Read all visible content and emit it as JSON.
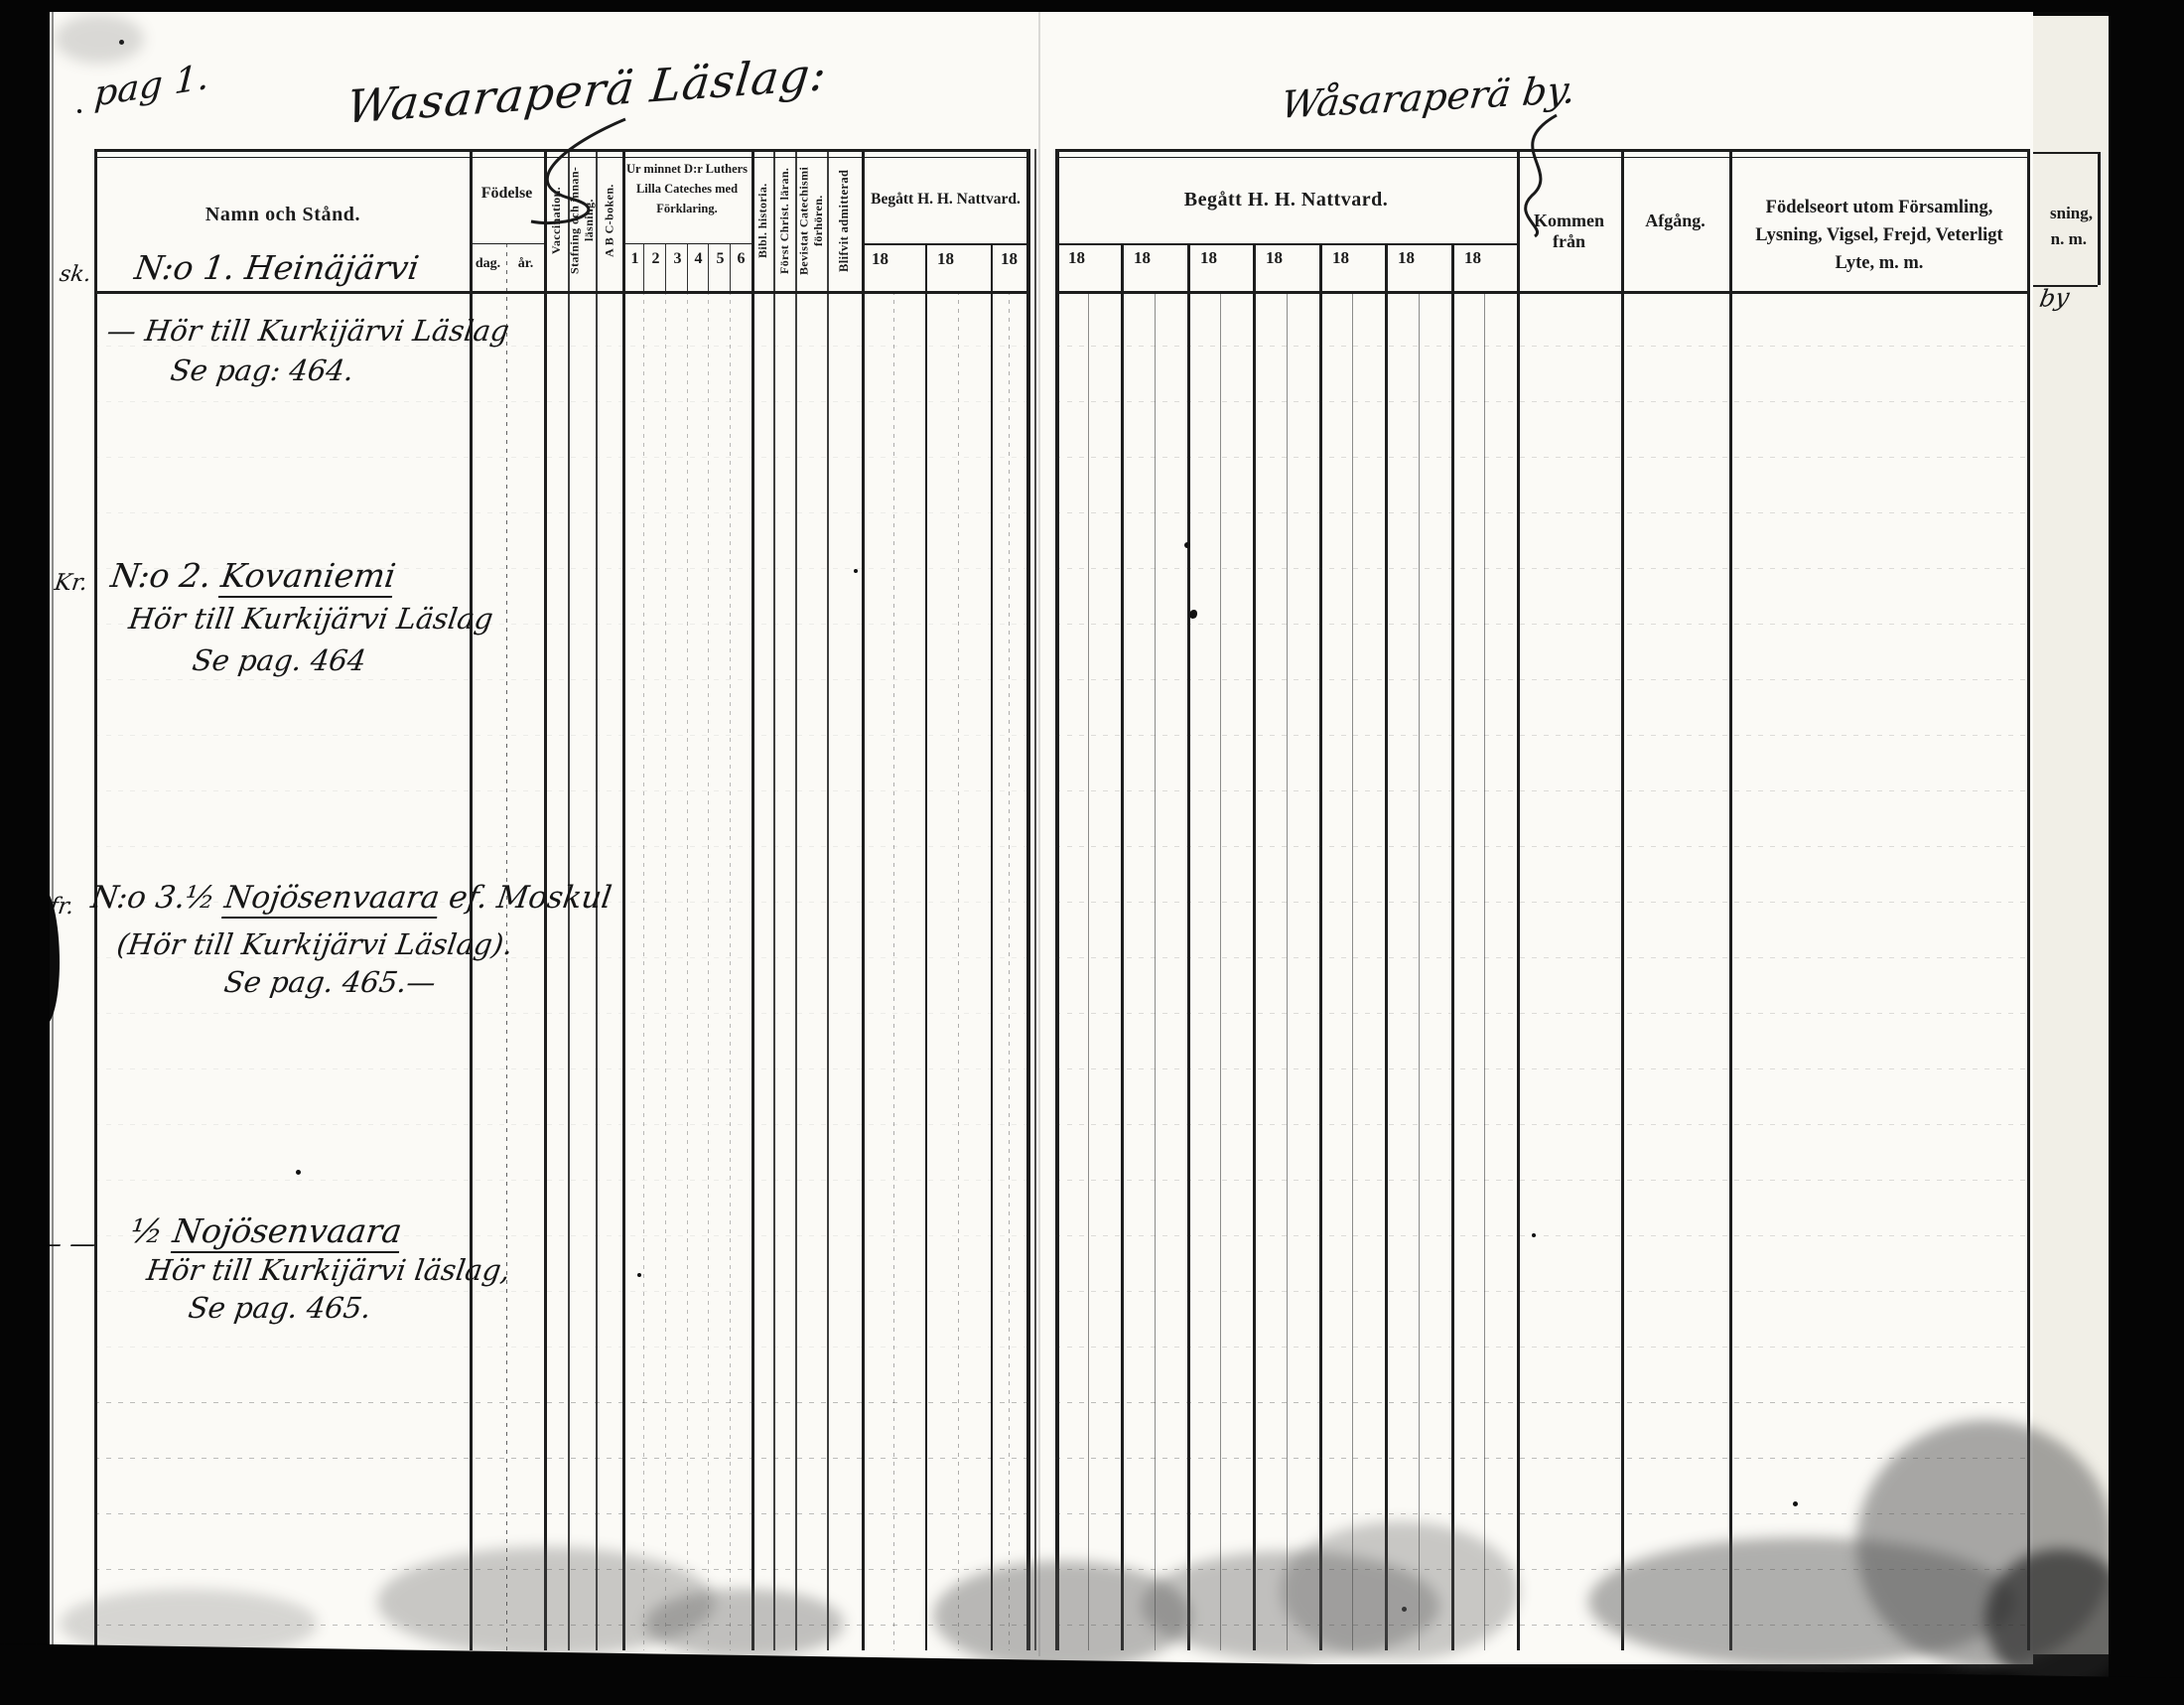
{
  "colors": {
    "paper": "#fbfaf6",
    "ink": "#1b1b1b",
    "handwriting": "#161616",
    "scan_background": "#0a0a0a"
  },
  "page_annotation": "pag 1.",
  "left_page": {
    "title_handwritten": "Wasaraperä Läslag:",
    "header": {
      "name": "Namn och Stånd.",
      "birth": "Födelse",
      "birth_day": "dag.",
      "birth_year": "år.",
      "vaccination": "Vaccination.",
      "spelling_reading": "Stafning och innan-läsning.",
      "abc_book": "A B C-boken.",
      "catechism": "Ur minnet D:r Luthers Lilla Cateches med Förklaring.",
      "catechism_cols": [
        "1",
        "2",
        "3",
        "4",
        "5",
        "6"
      ],
      "bible_history": "Bibl. historia.",
      "christian_doctrine": "Först Christ. läran.",
      "catechism_meeting": "Bevistat Catechismi förhören.",
      "admitted": "Blifvit admitterad",
      "communion": "Begått H. H. Nattvard.",
      "communion_years": [
        "18",
        "18",
        "18"
      ]
    },
    "entries": [
      {
        "margin": "sk.",
        "no": "N:o 1.",
        "name": "Heinäjärvi",
        "suffix": "",
        "note": "— Hör till Kurkijärvi Läslag",
        "page_ref": "Se pag: 464."
      },
      {
        "margin": "Kr.",
        "no": "N:o 2.",
        "name": "Kovaniemi",
        "suffix": "",
        "note": "Hör till Kurkijärvi Läslag",
        "page_ref": "Se pag. 464"
      },
      {
        "margin": "fr.",
        "no": "N:o 3.½",
        "name": "Nojösenvaara",
        "suffix": "ef. Moskul",
        "note": "(Hör till Kurkijärvi Läslag).",
        "page_ref": "Se pag. 465.—"
      },
      {
        "margin": "— —",
        "no": "½",
        "name": "Nojösenvaara",
        "suffix": "",
        "note": "Hör till Kurkijärvi läslag,",
        "page_ref": "Se pag. 465."
      }
    ]
  },
  "right_page": {
    "title_handwritten": "Wåsaraperä by.",
    "header": {
      "communion": "Begått H. H. Nattvard.",
      "communion_years": [
        "18",
        "18",
        "18",
        "18",
        "18",
        "18",
        "18"
      ],
      "come_from": "Kommen från",
      "departure": "Afgång.",
      "notes": "Födelseort utom Församling, Lysning, Vigsel, Frejd, Veterligt Lyte, m. m."
    }
  },
  "next_page_edge": {
    "text_line1": "sning,",
    "text_line2": "n. m.",
    "handwriting_fragment": "by"
  }
}
